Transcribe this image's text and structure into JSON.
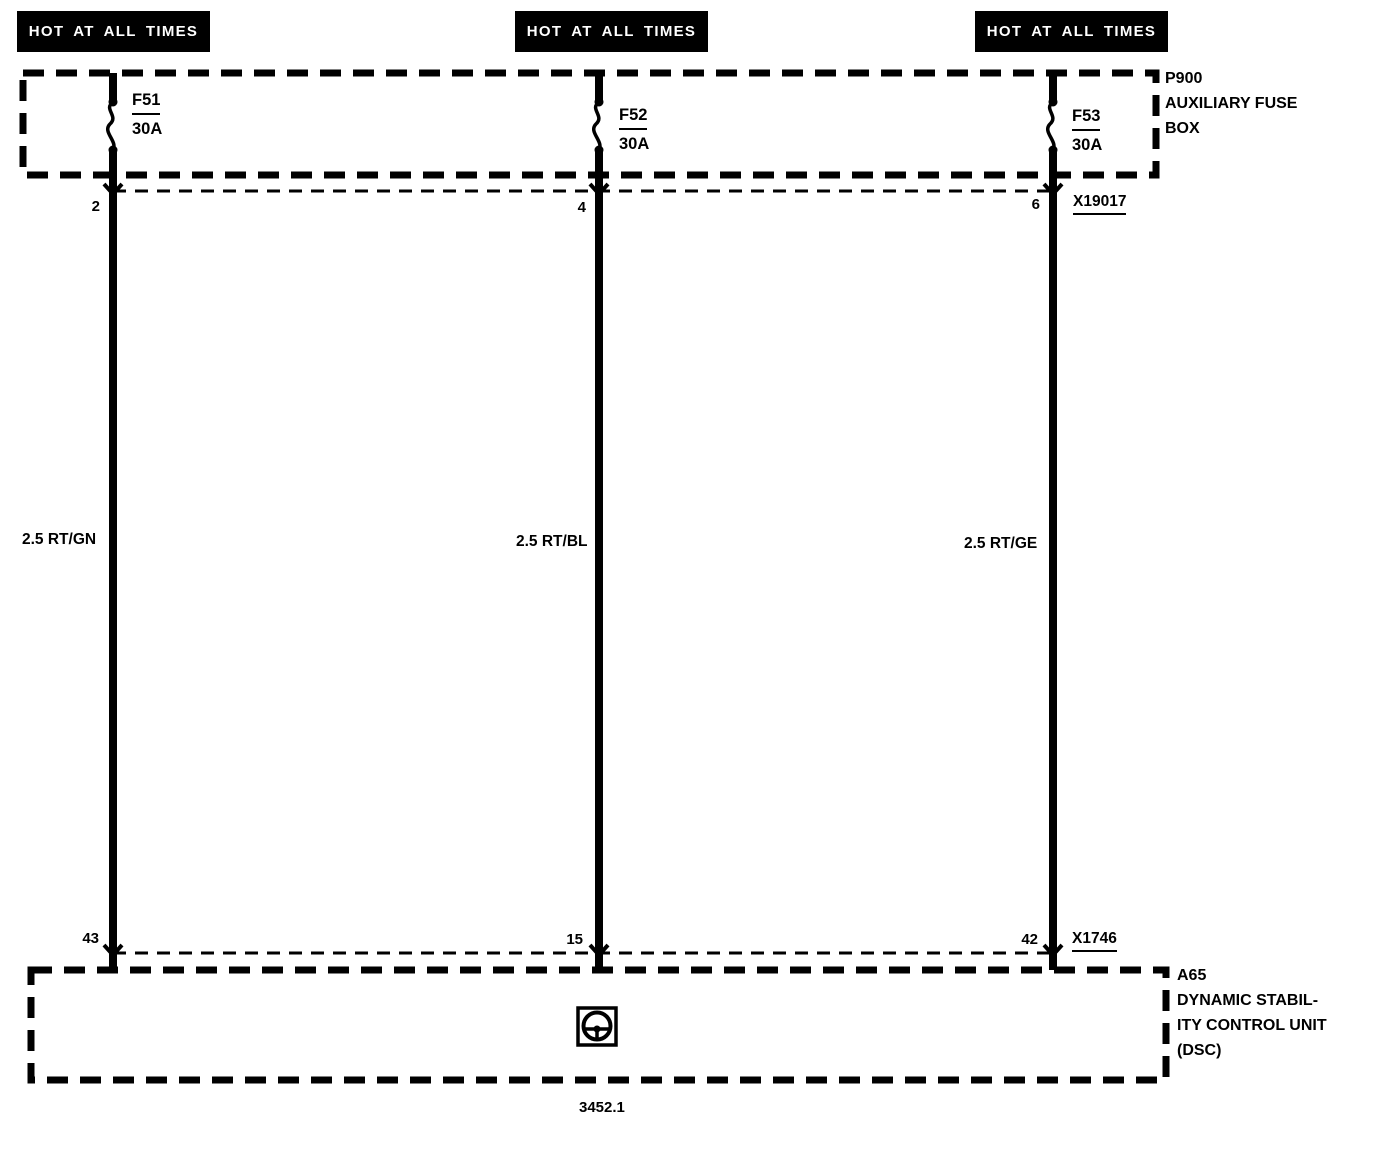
{
  "colors": {
    "ink": "#000000",
    "paper": "#ffffff"
  },
  "circuits": [
    {
      "banner": "HOT AT ALL TIMES",
      "fuse": "F51",
      "rating": "30A",
      "top_pin": "2",
      "wire_label": "2.5 RT/GN",
      "bottom_pin": "43"
    },
    {
      "banner": "HOT AT ALL TIMES",
      "fuse": "F52",
      "rating": "30A",
      "top_pin": "4",
      "wire_label": "2.5 RT/BL",
      "bottom_pin": "15"
    },
    {
      "banner": "HOT AT ALL TIMES",
      "fuse": "F53",
      "rating": "30A",
      "top_pin": "6",
      "wire_label": "2.5 RT/GE",
      "bottom_pin": "42"
    }
  ],
  "fuse_box": {
    "id": "P900",
    "name_line1": "AUXILIARY FUSE",
    "name_line2": "BOX"
  },
  "connectors": {
    "top": "X19017",
    "bottom": "X1746"
  },
  "control_unit": {
    "id": "A65",
    "name_line1": "DYNAMIC STABIL-",
    "name_line2": "ITY CONTROL UNIT",
    "name_line3": "(DSC)"
  },
  "icons": {
    "control_unit_symbol": "steering-wheel"
  },
  "footer": {
    "diagram_number": "3452.1"
  }
}
